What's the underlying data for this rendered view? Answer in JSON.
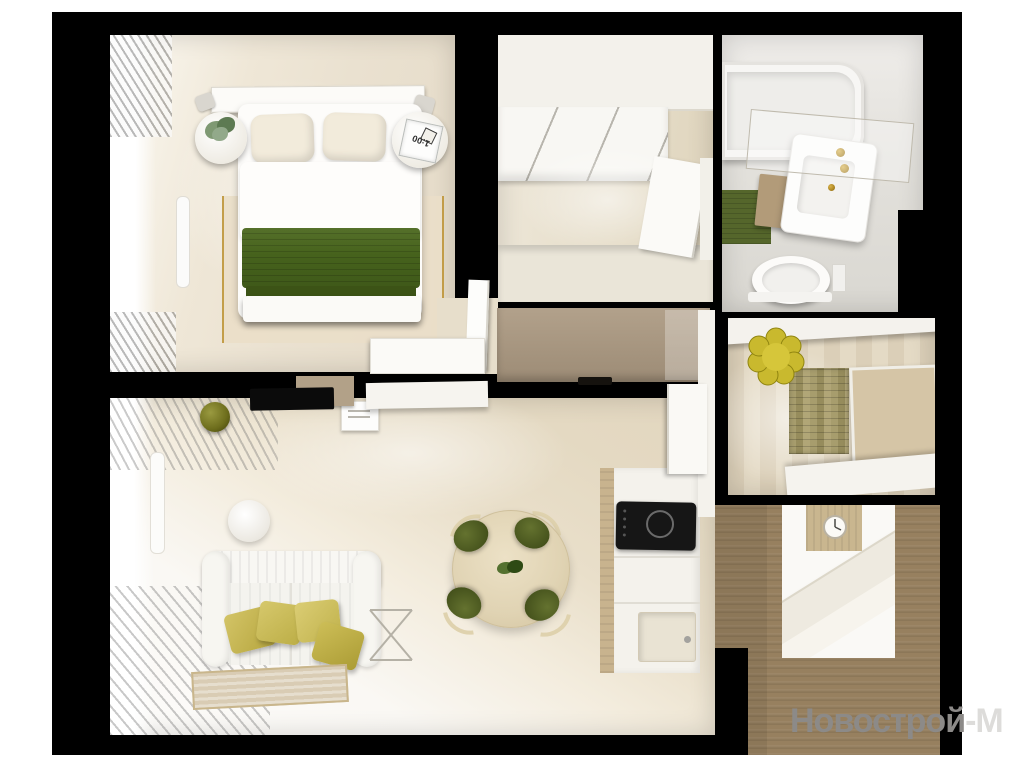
{
  "scene": {
    "type": "apartment-floor-plan-3d-render-top-view",
    "rooms": [
      "bedroom",
      "entry-hall",
      "bathroom",
      "inner-hall",
      "walk-in-closet",
      "living-room",
      "kitchen-dining"
    ]
  },
  "watermark": {
    "part1": "Новострой",
    "part2": "-М"
  },
  "bedroom": {
    "clock_time": "1:00"
  },
  "colors": {
    "background": "#ffffff",
    "walls": "#000000",
    "bedroom_blanket_green": "#46621c",
    "sofa_pillow_olive": "#cdbf5a",
    "pouf_yellow": "#c9b92e",
    "bath_mat_green": "#55662b",
    "closet_wood_brown": "#97805f",
    "floor_wood_light": "#e7dcc6",
    "gold_fixture": "#a9821f",
    "watermark_gray": "#8c8a88"
  }
}
